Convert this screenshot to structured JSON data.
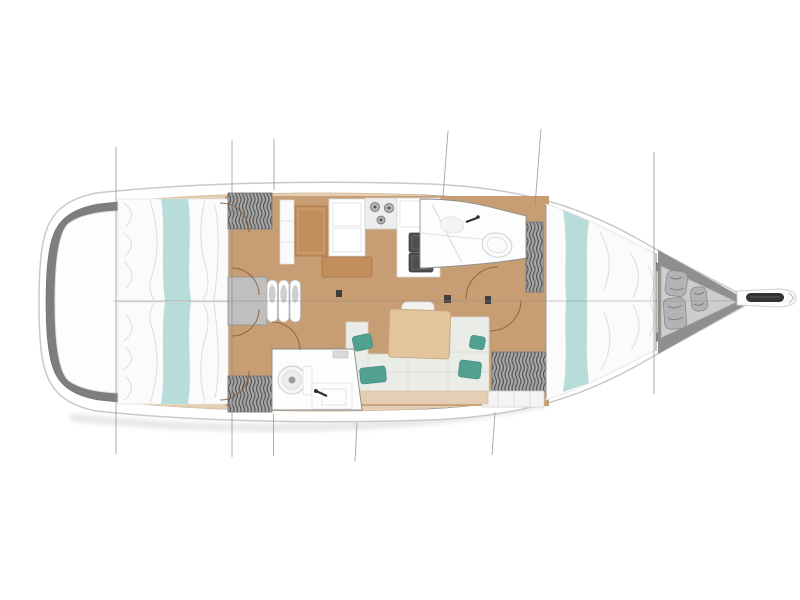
{
  "meta": {
    "description_of_depiction": "sailboat-interior-floor-plan-top-view",
    "visible_text": ""
  },
  "semantic_regions": [
    "hull",
    "side-deck",
    "transom-platform",
    "aft-cabin-berth-top",
    "aft-cabin-berth-bottom",
    "wardrobe-lockers",
    "companionway-steps",
    "nav-station-desk",
    "galley-cabinet",
    "galley-stove",
    "galley-sinks",
    "saloon-sofa",
    "saloon-table",
    "aft-head",
    "fore-head",
    "fore-cabin-berth",
    "sail-locker-bags",
    "bowsprit-anchor-roller",
    "section-lines",
    "centerline",
    "door-swing-arcs"
  ],
  "colors": {
    "page_bg": "#ffffff",
    "hull_white": "#ffffff",
    "hull_outline": "#c9c9c9",
    "deck_gray": "#7e7e7e",
    "transom_white": "#fdfdfd",
    "liner_beige": "#e4cfb4",
    "floor_tan": "#c79e73",
    "wood_brown": "#c28e5c",
    "table_wood": "#e2c49d",
    "bed_white": "#fbfbfb",
    "bed_teal": "#b7dcda",
    "cushion_teal": "#52a091",
    "sofa_white": "#eaece8",
    "locker_gray": "#a6a6a6",
    "steps_gray": "#bfbfbf",
    "fixture_white": "#fdfdfd",
    "sink_dark": "#4e4e4e",
    "stove_gray": "#ededed",
    "forepeak_gray": "#cdcdcd",
    "bag_gray": "#b3b3b3",
    "anchor_dark": "#333333",
    "section_line": "#8f8f8f",
    "door_arc": "#8a5a33",
    "shadow": "#dcdcdc"
  }
}
